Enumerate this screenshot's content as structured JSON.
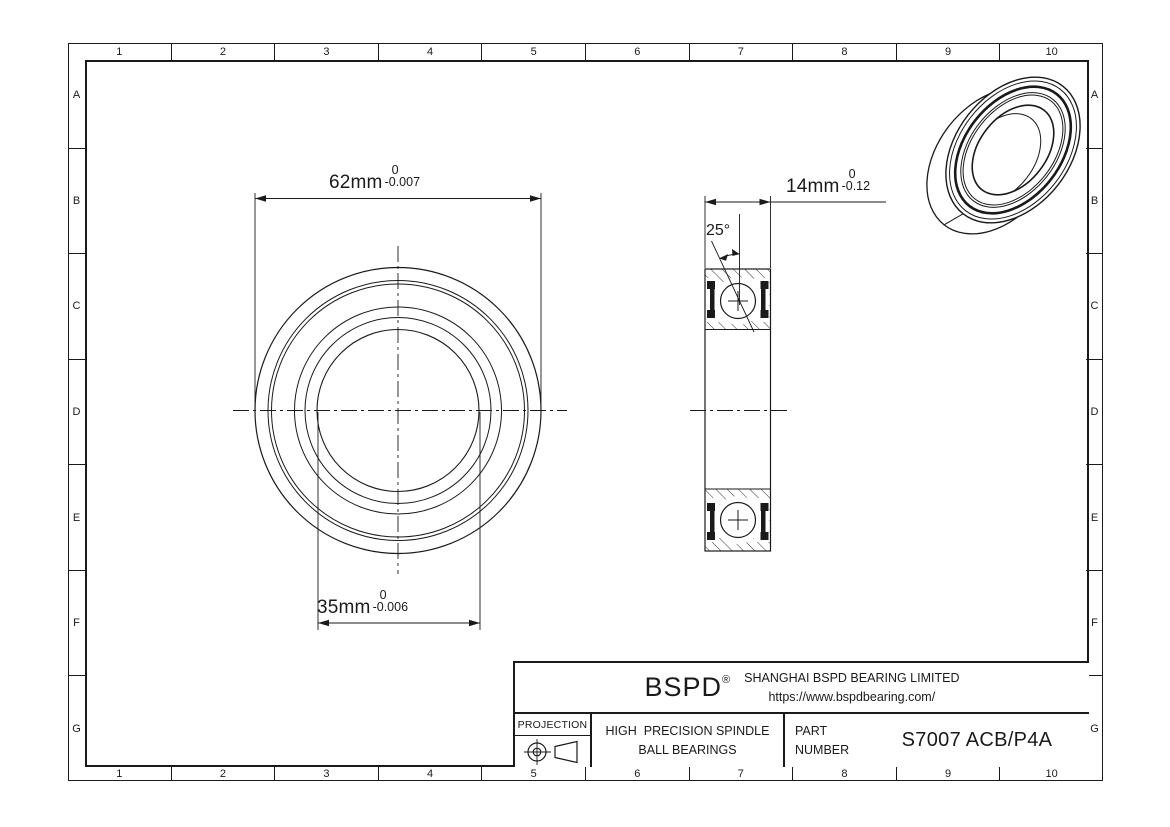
{
  "colors": {
    "line": "#1a1a1a",
    "background": "#ffffff"
  },
  "grid": {
    "columns": [
      "1",
      "2",
      "3",
      "4",
      "5",
      "6",
      "7",
      "8",
      "9",
      "10"
    ],
    "rows": [
      "A",
      "B",
      "C",
      "D",
      "E",
      "F",
      "G"
    ]
  },
  "dimensions": {
    "outer_diameter": {
      "value": "62mm",
      "tolerance_upper": "0",
      "tolerance_lower": "-0.007"
    },
    "bore_diameter": {
      "value": "35mm",
      "tolerance_upper": "0",
      "tolerance_lower": "-0.006"
    },
    "width": {
      "value": "14mm",
      "tolerance_upper": "0",
      "tolerance_lower": "-0.12"
    },
    "contact_angle": "25°"
  },
  "title_block": {
    "logo": "BSPD",
    "registered_mark": "®",
    "company_name": "SHANGHAI BSPD BEARING LIMITED",
    "company_url": "https://www.bspdbearing.com/",
    "projection_label": "PROJECTION",
    "product_line1": "HIGH  PRECISION SPINDLE",
    "product_line2": "BALL BEARINGS",
    "part_label_line1": "PART",
    "part_label_line2": "NUMBER",
    "part_number": "S7007 ACB/P4A"
  }
}
